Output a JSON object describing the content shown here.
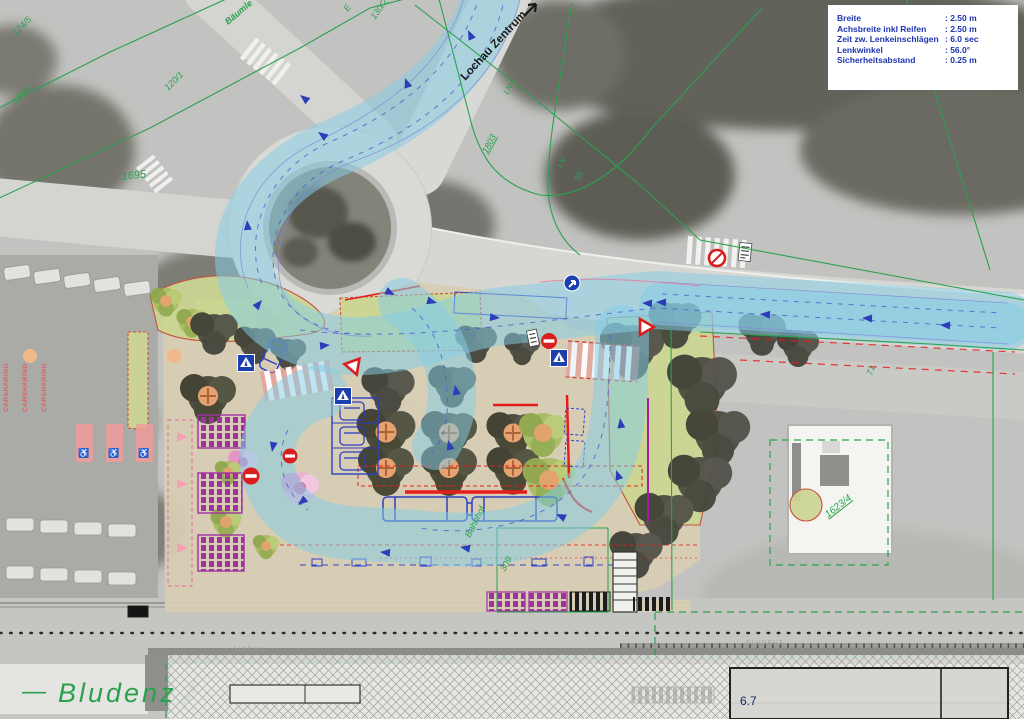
{
  "legend": {
    "rows": [
      {
        "label": "Breite",
        "value": ":  2.50 m"
      },
      {
        "label": "Achsbreite inkl Reifen",
        "value": ":  2.50 m"
      },
      {
        "label": "Zeit zw. Lenkeinschlägen",
        "value": ":  6.0 sec"
      },
      {
        "label": "Lenkwinkel",
        "value": ":  56.0°"
      },
      {
        "label": "Sicherheitsabstand",
        "value": ":  0.25 m"
      }
    ]
  },
  "map": {
    "street_labels": {
      "baeumle": "Bäumle",
      "lochau_zentrum": "Lochau Zentrum",
      "bludenz_dash": "—",
      "bludenz": "Bludenz",
      "lindau_faint": "LINDAU",
      "bludenz_faint": "BLUDENZ"
    },
    "parcels": {
      "p124_5": "124/5",
      "p124_6": "124/6",
      "p120_1": "120/1",
      "p1695": "1695",
      "p130_2": "130/2",
      "e_mark": "E",
      "p1803": "1803",
      "ln_a": "LN",
      "ln_b": "LN",
      "p95": "95",
      "p71": "71",
      "p1623_4": "1623/4",
      "p1623_1": "1623/1",
      "p309": "309"
    },
    "annotations": {
      "bahnhof": "Bahnhof",
      "measure_6_7": "6.7",
      "carsharing": "CARSHARING"
    },
    "icons": {
      "no_entry": "no-entry-sign",
      "no_stopping": "no-stopping-sign",
      "mandatory_direction": "mandatory-direction-sign",
      "crosswalk": "crosswalk-sign",
      "yield": "yield-sign",
      "wheelchair": "♿"
    },
    "colors": {
      "swept_path_blue": "#84cee6",
      "cadastral_green": "#2aa14e",
      "legend_text_blue": "#1d33b0",
      "site_beige": "#d7ceb3",
      "green_area": "#cbd592",
      "bike_rack_purple": "#a032a0",
      "platform_red": "#e81c1c",
      "vehicle_blue": "#2d3fc0",
      "carsharing_red": "#e06060"
    }
  }
}
